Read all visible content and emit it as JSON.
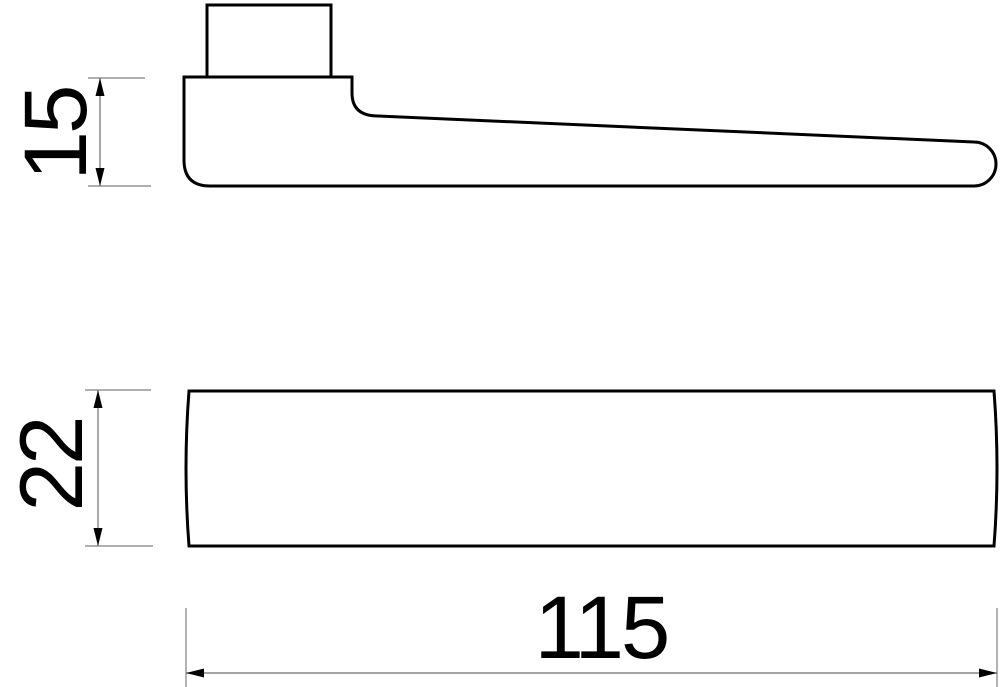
{
  "dimensions": {
    "lever_height": {
      "value": "15"
    },
    "grip_width": {
      "value": "22"
    },
    "overall_length": {
      "value": "115"
    }
  },
  "colors": {
    "background": "#ffffff",
    "object_outline": "#000000",
    "dimension_line": "#6e6e6e",
    "extension_line": "#808080",
    "dimension_text": "#000000"
  }
}
